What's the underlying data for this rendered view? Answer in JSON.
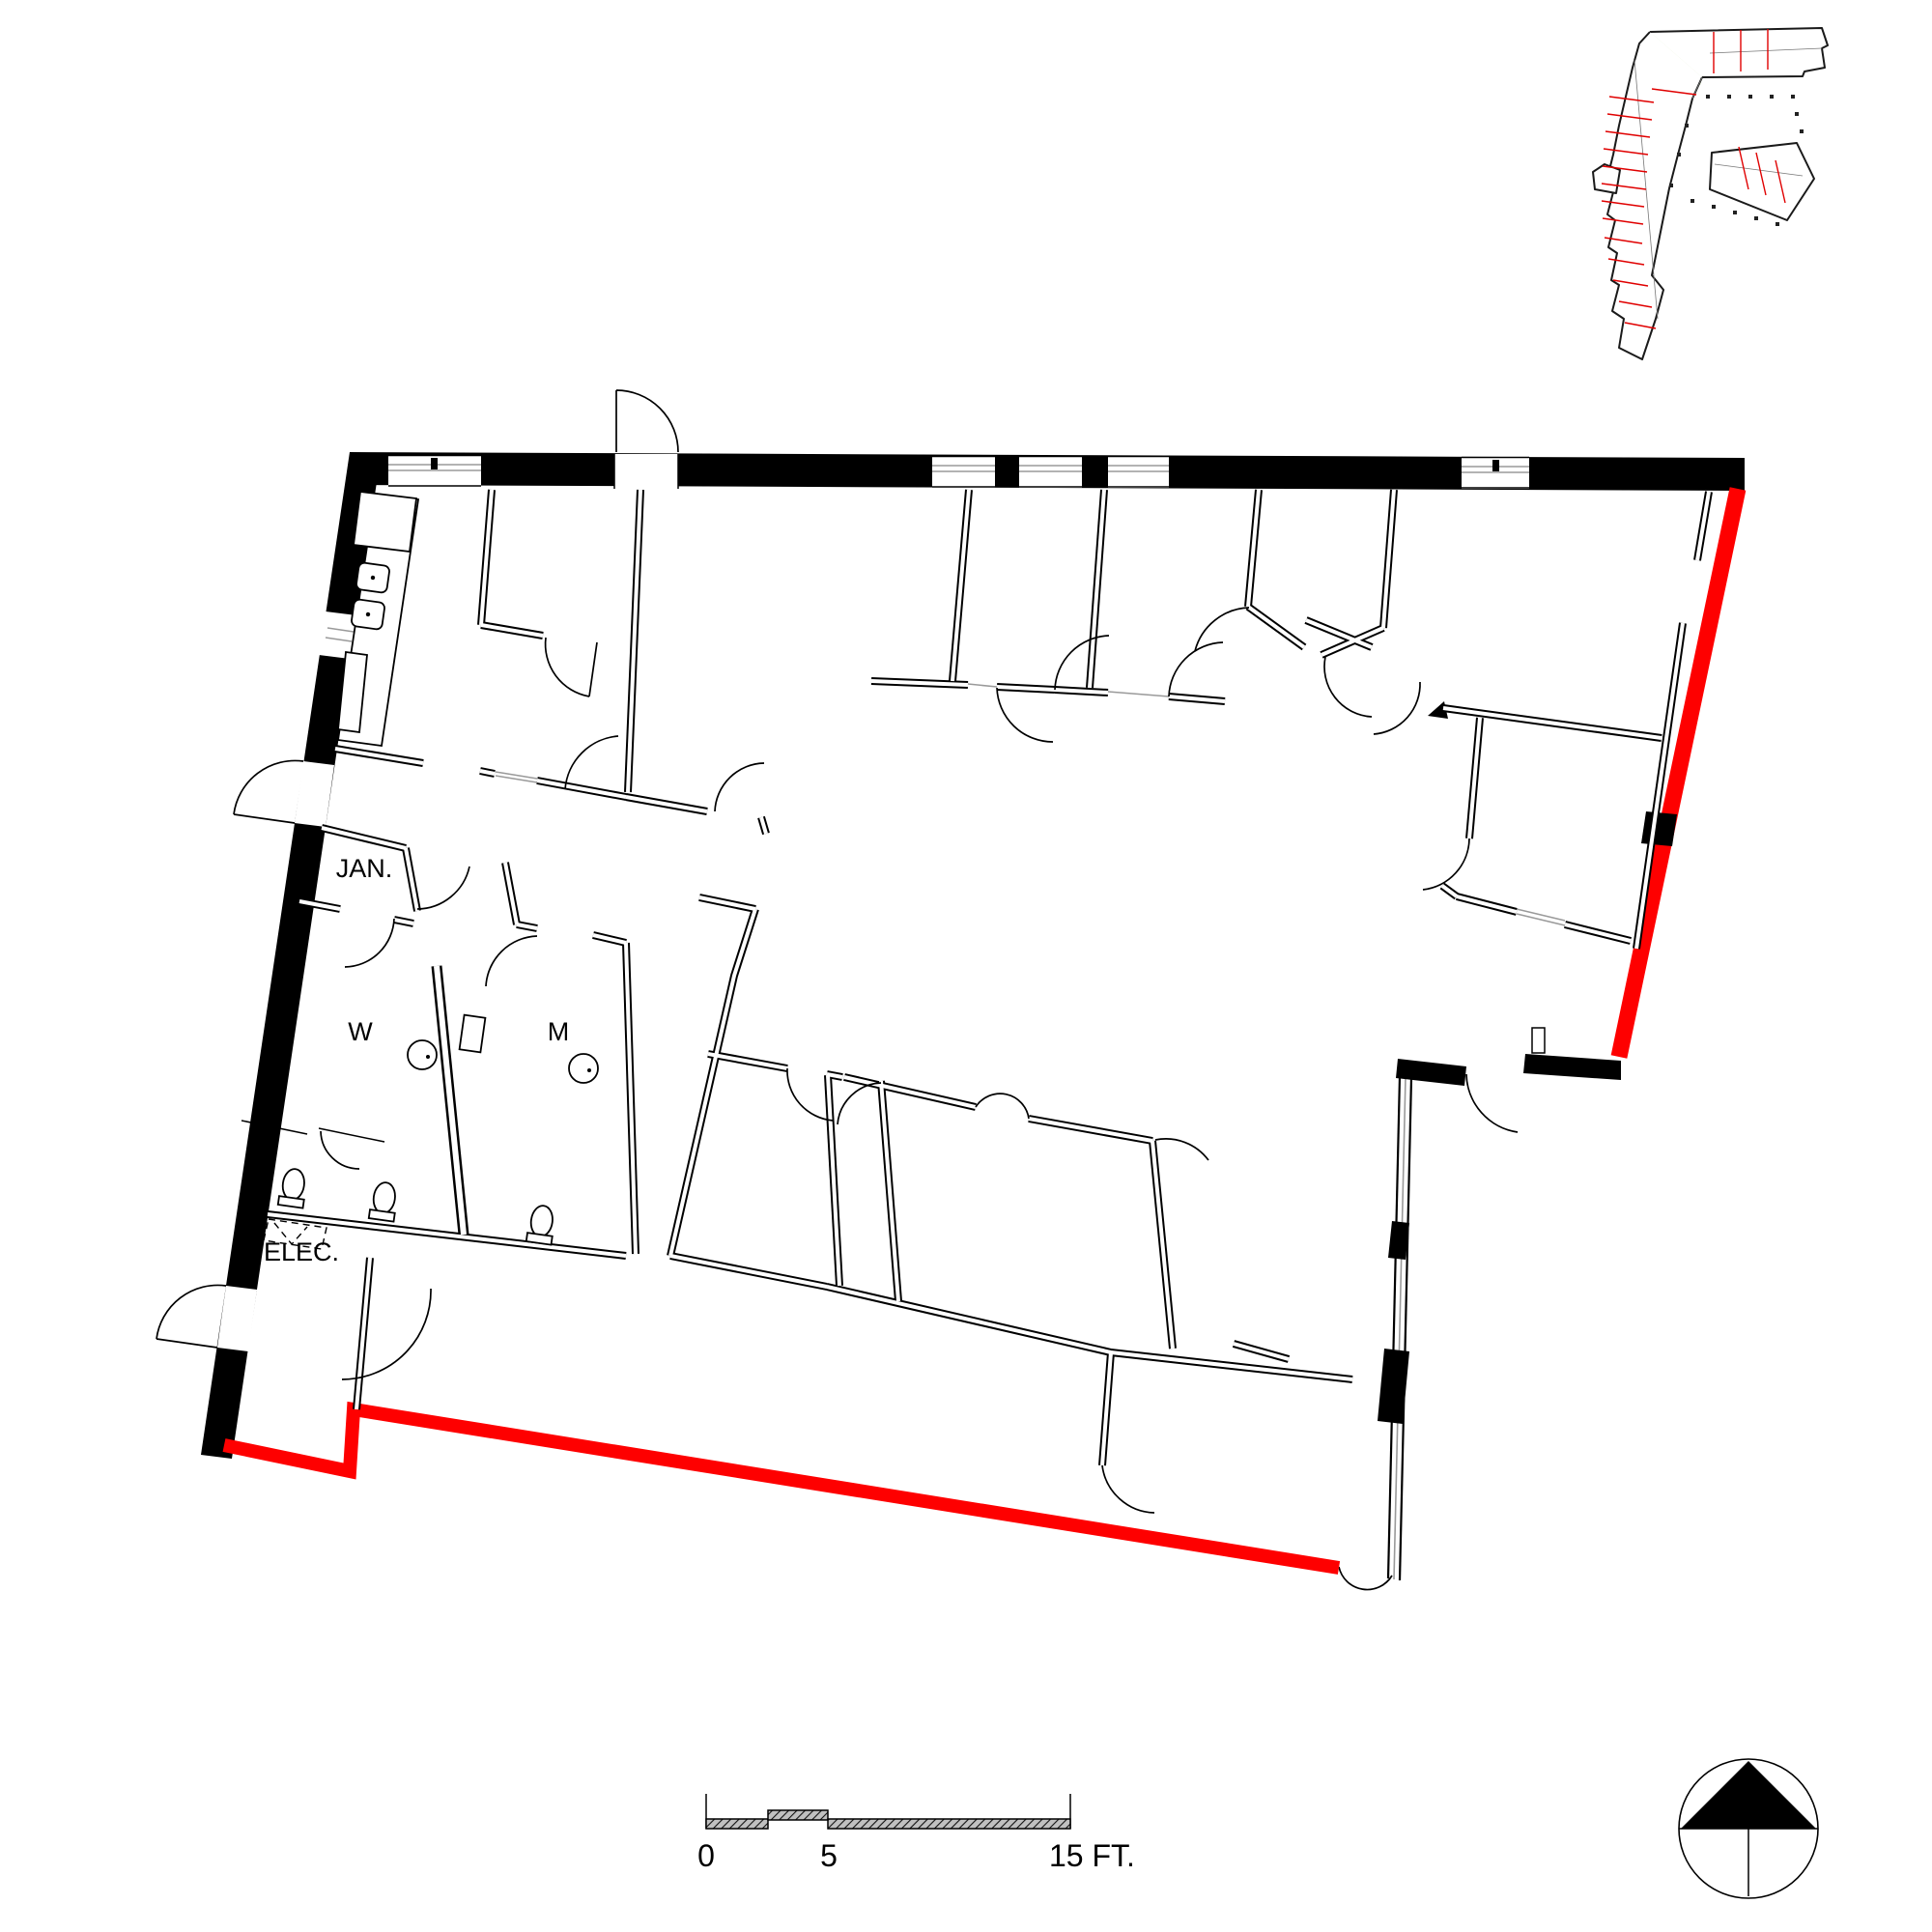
{
  "document": {
    "type": "architectural-floor-plan",
    "background": "#ffffff"
  },
  "plan_labels": {
    "janitor_closet": "JAN.",
    "womens_restroom": "W",
    "mens_restroom": "M",
    "electrical_room": "ELEC."
  },
  "scale_bar": {
    "start_label": "0",
    "mid_label": "5",
    "end_label": "15 FT."
  },
  "colors": {
    "wall_poche_black": "#000000",
    "highlight_red": "#fe0000",
    "glazing_gray": "#9a9a9a",
    "keyplan_suite_green": "#d9eaba",
    "keyplan_unit_line_red": "#e00000"
  },
  "key_plan": {
    "description_of_highlight": "suite highlighted green at upper-left wing of building key plan"
  },
  "north_arrow": {
    "style": "filled triangle in circle, pointing up"
  }
}
